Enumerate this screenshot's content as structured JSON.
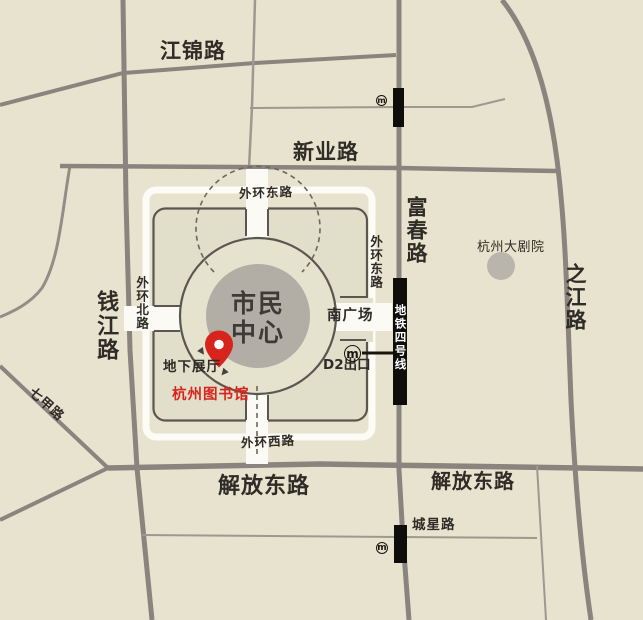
{
  "roads": {
    "jiangjin": "江锦路",
    "xinye": "新业路",
    "fuchun": "富春路",
    "qianjiang": "钱江路",
    "zhijiang": "之江路",
    "qijia": "七甲路",
    "jiefang_east_left": "解放东路",
    "jiefang_east_right": "解放东路",
    "chengxing": "城星路",
    "outer_ring_east_top": "外环东路",
    "outer_ring_east_side": "外环东路",
    "outer_ring_north": "外环北路",
    "outer_ring_west": "外环西路"
  },
  "places": {
    "citizen_center": "市民中心",
    "south_square": "南广场",
    "underground_hall": "地下展厅",
    "hangzhou_library": "杭州图书馆",
    "d2_exit": "D2出口",
    "grand_theatre": "杭州大剧院",
    "metro_line4": "地铁四号线"
  },
  "icons": {
    "metro_glyph": "m"
  },
  "colors": {
    "background": "#e7e3ce",
    "road_gray": "#89847d",
    "metro_black": "#0e0d0b",
    "building_gray": "#b2aea6",
    "accent_red": "#d7251d"
  }
}
